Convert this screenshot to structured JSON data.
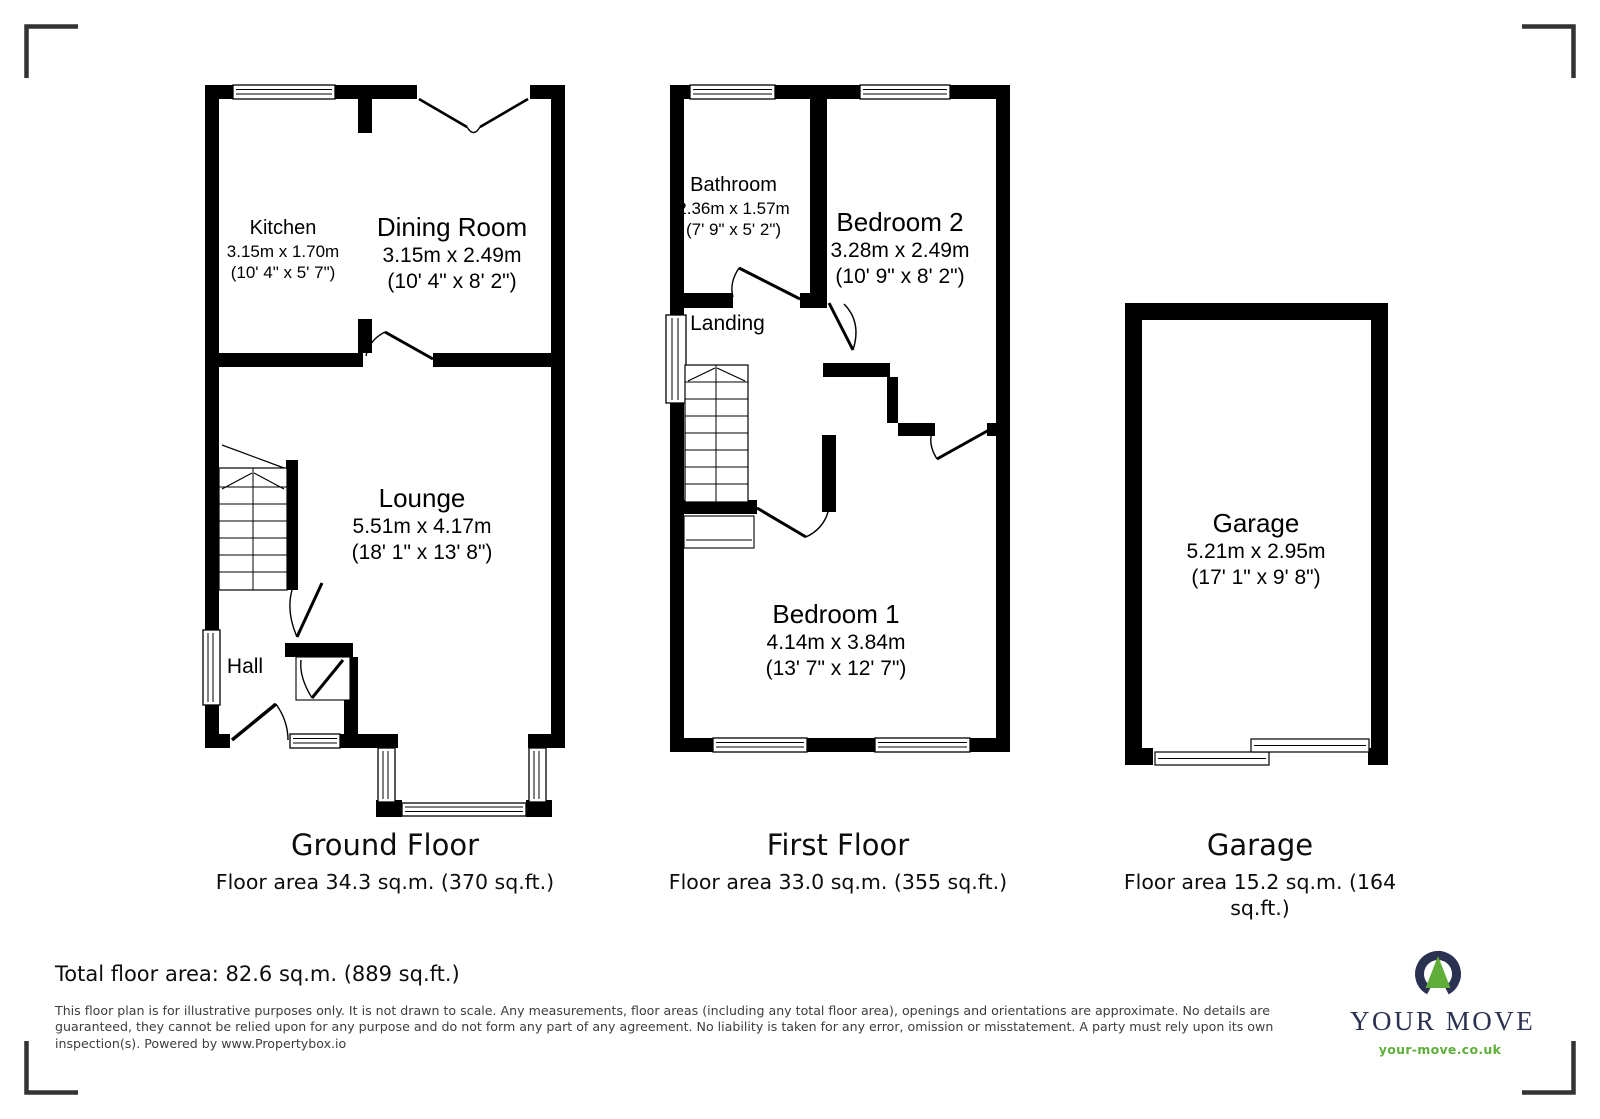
{
  "rooms": {
    "kitchen": {
      "name": "Kitchen",
      "m": "3.15m x 1.70m",
      "ft": "(10' 4\" x 5' 7\")"
    },
    "dining": {
      "name": "Dining Room",
      "m": "3.15m x 2.49m",
      "ft": "(10' 4\" x 8' 2\")"
    },
    "lounge": {
      "name": "Lounge",
      "m": "5.51m x 4.17m",
      "ft": "(18' 1\" x 13' 8\")"
    },
    "hall": {
      "name": "Hall"
    },
    "bathroom": {
      "name": "Bathroom",
      "m": "2.36m x 1.57m",
      "ft": "(7' 9\" x 5' 2\")"
    },
    "bedroom2": {
      "name": "Bedroom 2",
      "m": "3.28m x 2.49m",
      "ft": "(10' 9\" x 8' 2\")"
    },
    "landing": {
      "name": "Landing"
    },
    "bedroom1": {
      "name": "Bedroom 1",
      "m": "4.14m x 3.84m",
      "ft": "(13' 7\" x 12' 7\")"
    },
    "garage": {
      "name": "Garage",
      "m": "5.21m x 2.95m",
      "ft": "(17' 1\" x 9' 8\")"
    }
  },
  "titles": {
    "ground": {
      "title": "Ground Floor",
      "area": "Floor area 34.3 sq.m. (370 sq.ft.)"
    },
    "first": {
      "title": "First Floor",
      "area": "Floor area 33.0 sq.m. (355 sq.ft.)"
    },
    "garage": {
      "title": "Garage",
      "area": "Floor area 15.2 sq.m. (164 sq.ft.)"
    }
  },
  "total_floor_area": "Total floor area: 82.6 sq.m. (889 sq.ft.)",
  "disclaimer_lines": {
    "l1": "This floor plan is for illustrative purposes only. It is not drawn to scale. Any measurements, floor areas (including any total floor area), openings and orientations are approximate. No details are",
    "l2": "guaranteed, they cannot be relied upon for any purpose and do not form any part of any agreement. No liability is taken for any error, omission or misstatement. A party must rely upon its own",
    "l3": "inspection(s). Powered by www.Propertybox.io"
  },
  "logo": {
    "brand": "YOUR MOVE",
    "website": "your-move.co.uk"
  },
  "colors": {
    "wall": "#000000",
    "logo_navy": "#2b3150",
    "logo_green": "#5fae3a",
    "disclaimer_text": "#3d3d3d",
    "corner_mark": "#333333"
  }
}
